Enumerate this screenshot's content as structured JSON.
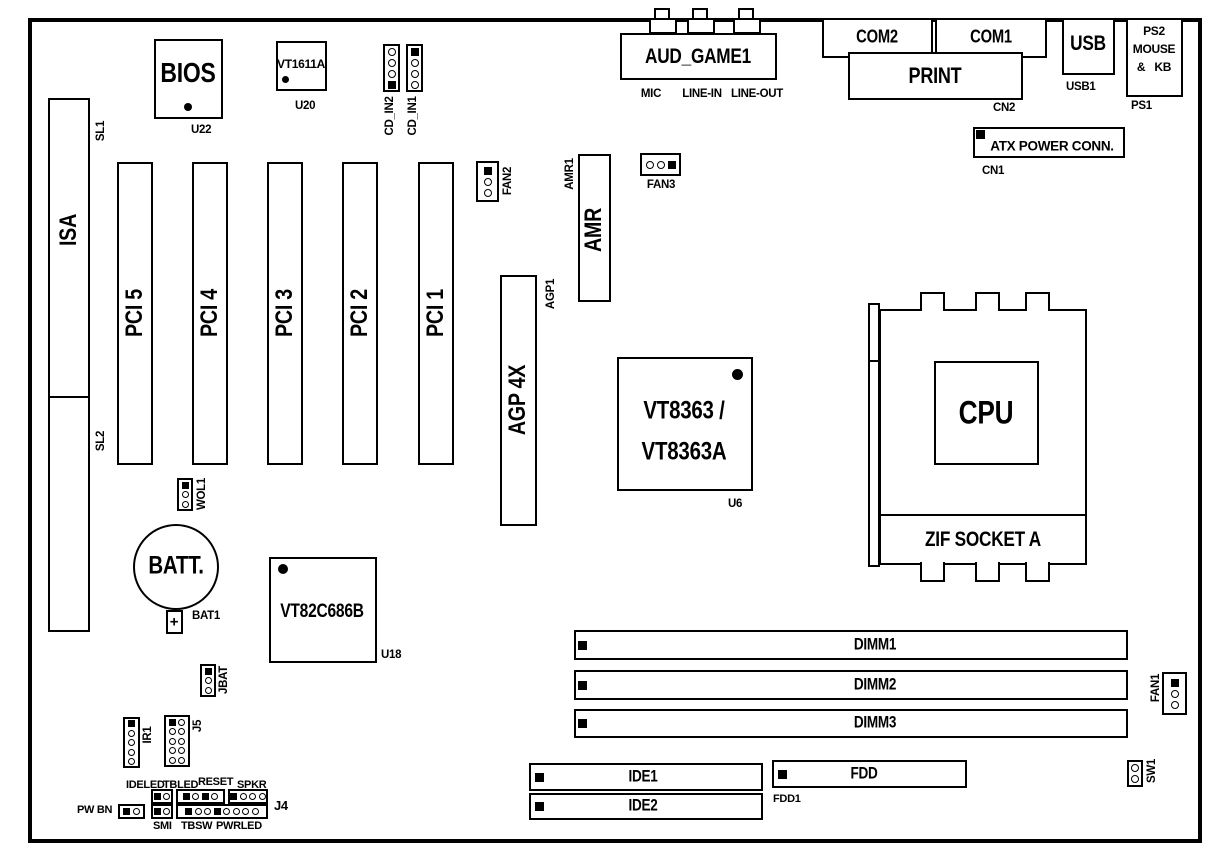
{
  "io_panel": {
    "aud_game1": {
      "label": "AUD_GAME1",
      "jack_labels": [
        "MIC",
        "LINE-IN",
        "LINE-OUT"
      ]
    },
    "com2": {
      "label": "COM2"
    },
    "com1": {
      "label": "COM1"
    },
    "print": {
      "label": "PRINT",
      "ref": "CN2"
    },
    "usb": {
      "label": "USB",
      "ref": "USB1"
    },
    "ps2": {
      "line1": "PS2",
      "line2": "MOUSE",
      "line3": "&   KB",
      "ref": "PS1"
    },
    "atx_power": {
      "label": "ATX POWER CONN.",
      "ref": "CN1"
    }
  },
  "slots": {
    "isa": {
      "label": "ISA",
      "upper_ref": "SL1",
      "lower_ref": "SL2"
    },
    "pci": [
      {
        "label": "PCI 5"
      },
      {
        "label": "PCI 4"
      },
      {
        "label": "PCI 3"
      },
      {
        "label": "PCI 2"
      },
      {
        "label": "PCI 1"
      }
    ],
    "agp": {
      "label": "AGP 4X",
      "ref": "AGP1"
    },
    "amr": {
      "label": "AMR",
      "ref": "AMR1"
    },
    "dimm": [
      {
        "label": "DIMM1"
      },
      {
        "label": "DIMM2"
      },
      {
        "label": "DIMM3"
      }
    ]
  },
  "chips": {
    "bios": {
      "label": "BIOS",
      "ref": "U22"
    },
    "audio_codec": {
      "label": "VT1611A",
      "ref": "U20"
    },
    "north_bridge": {
      "line1": "VT8363 /",
      "line2": "VT8363A",
      "ref": "U6"
    },
    "south_bridge": {
      "label": "VT82C686B",
      "ref": "U18"
    }
  },
  "cpu": {
    "label": "CPU",
    "socket_label": "ZIF SOCKET A"
  },
  "battery": {
    "label": "BATT.",
    "polarity": "+",
    "ref": "BAT1"
  },
  "headers": {
    "cd_in2": {
      "label": "CD_IN2"
    },
    "cd_in1": {
      "label": "CD_IN1"
    },
    "fan2": {
      "label": "FAN2"
    },
    "fan3": {
      "label": "FAN3"
    },
    "fan1": {
      "label": "FAN1"
    },
    "wol": {
      "label": "WOL1"
    },
    "jbat": {
      "label": "JBAT"
    },
    "ir": {
      "label": "IR1"
    },
    "j5": {
      "label": "J5"
    },
    "sw1": {
      "label": "SW1"
    }
  },
  "storage": {
    "ide1": {
      "label": "IDE1"
    },
    "ide2": {
      "label": "IDE2"
    },
    "fdd": {
      "label": "FDD",
      "ref": "FDD1"
    }
  },
  "front_panel": {
    "ref": "J4",
    "power_button": "PW BN",
    "top_labels": [
      "IDELED",
      "TBLED",
      "RESET",
      "SPKR"
    ],
    "bottom_labels": [
      "SMI",
      "TBSW",
      "PWRLED"
    ]
  }
}
